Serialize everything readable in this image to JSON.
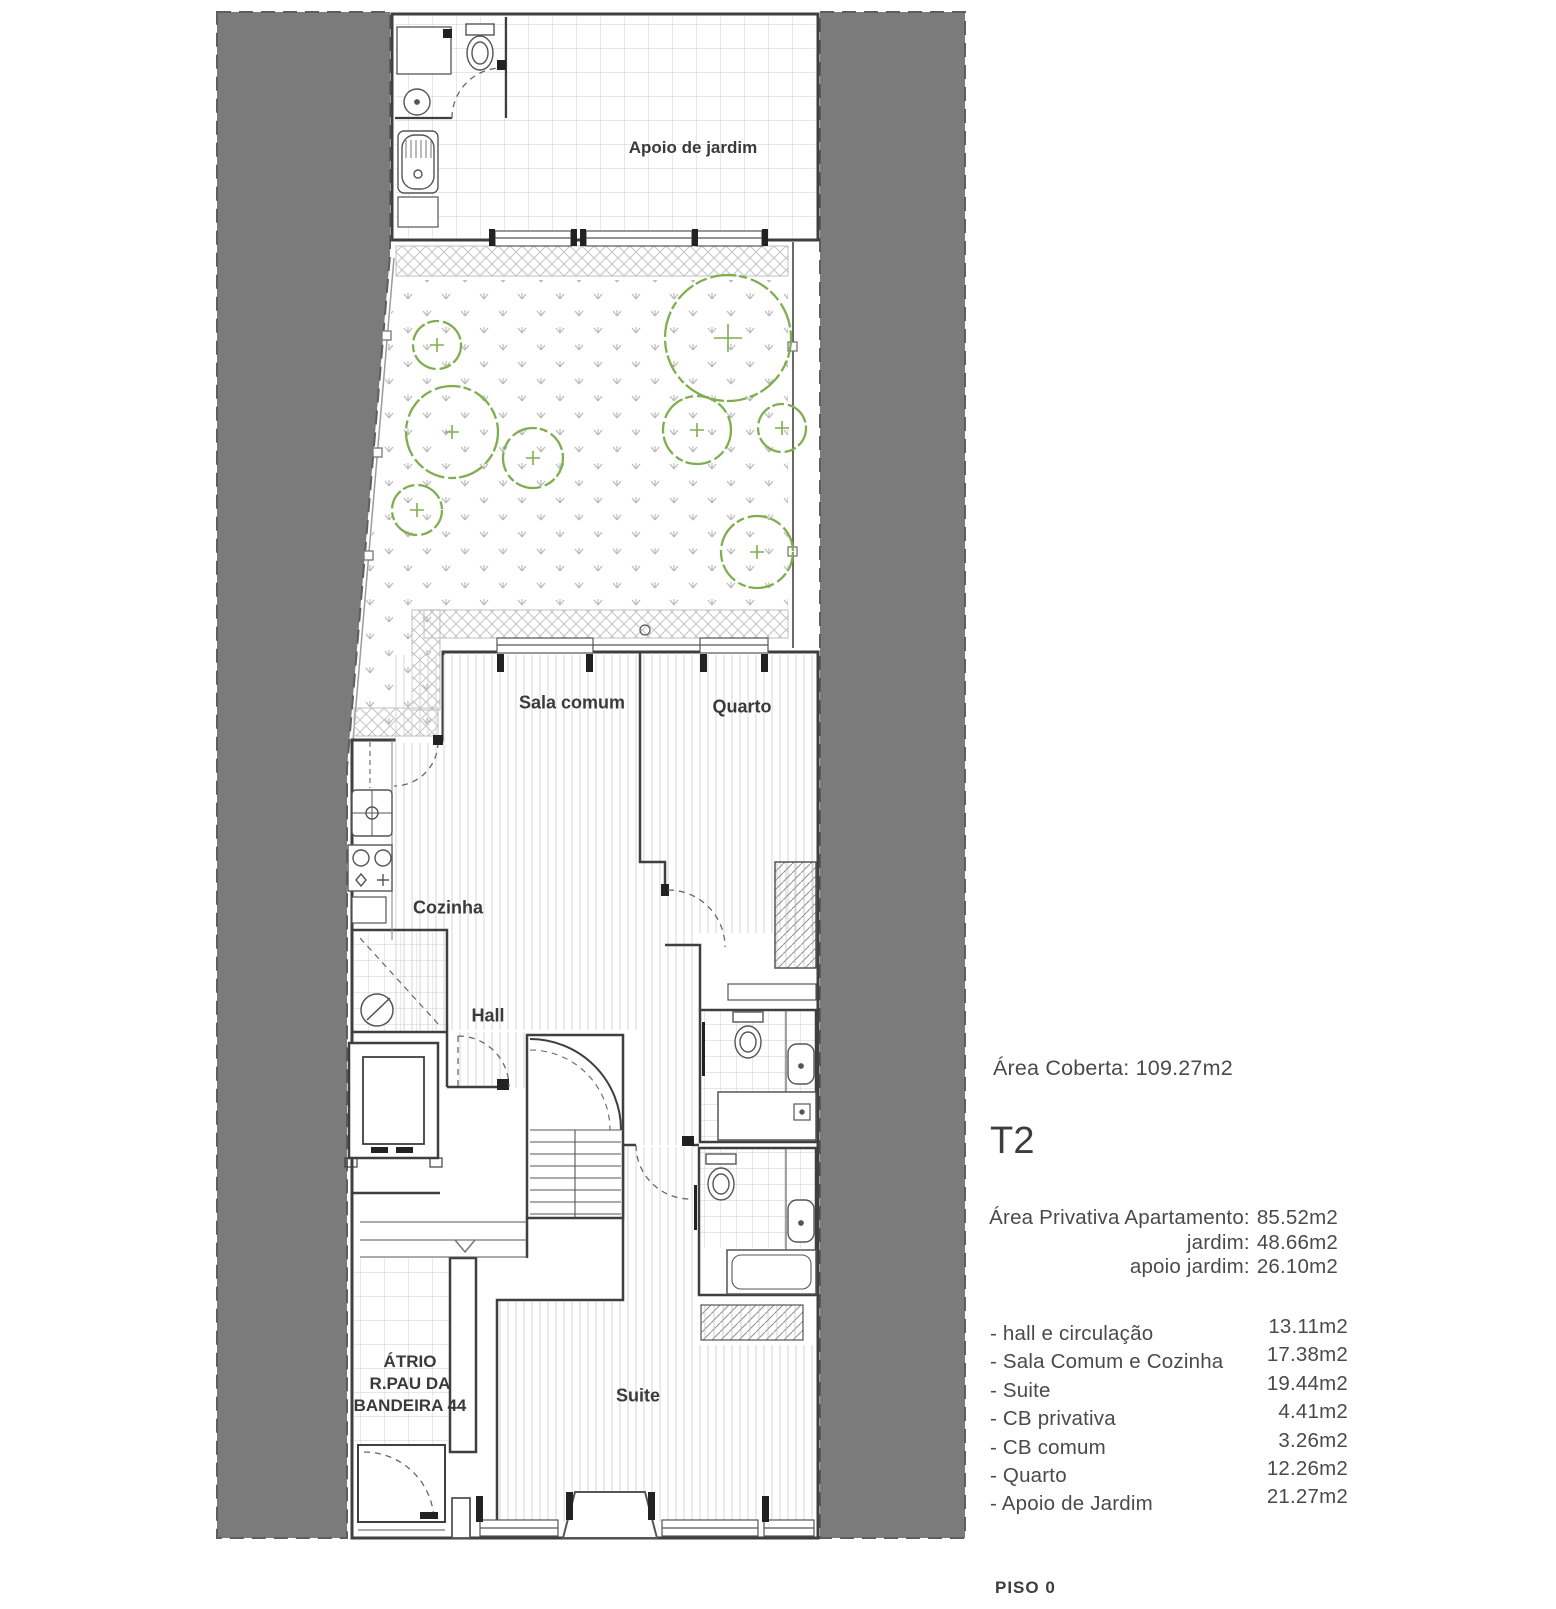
{
  "floor_plan": {
    "rooms": [
      {
        "id": "apoio-de-jardim",
        "label": "Apoio de jardim"
      },
      {
        "id": "sala-comum",
        "label": "Sala comum"
      },
      {
        "id": "quarto",
        "label": "Quarto"
      },
      {
        "id": "cozinha",
        "label": "Cozinha"
      },
      {
        "id": "hall",
        "label": "Hall"
      },
      {
        "id": "suite",
        "label": "Suite"
      }
    ],
    "atrio": {
      "line1": "ÁTRIO",
      "line2": "R.PAU DA",
      "line3": "BANDEIRA 44"
    }
  },
  "info_panel": {
    "area_coberta": "Área Coberta: 109.27m2",
    "unit_type": "T2",
    "private_areas": [
      {
        "label": "Área Privativa Apartamento:",
        "value": "85.52m2"
      },
      {
        "label": "jardim:",
        "value": "48.66m2"
      },
      {
        "label": "apoio jardim:",
        "value": "26.10m2"
      }
    ],
    "room_areas": [
      {
        "label": "- hall e circulação",
        "value": "13.11m2"
      },
      {
        "label": "- Sala Comum e Cozinha",
        "value": "17.38m2"
      },
      {
        "label": "- Suite",
        "value": "19.44m2"
      },
      {
        "label": "- CB privativa",
        "value": "4.41m2"
      },
      {
        "label": "- CB comum",
        "value": "3.26m2"
      },
      {
        "label": "- Quarto",
        "value": "12.26m2"
      },
      {
        "label": "- Apoio de Jardim",
        "value": "21.27m2"
      }
    ],
    "floor_label": "PISO 0"
  },
  "colors": {
    "neighbor_gray": "#7b7b7b",
    "wall": "#3f3f3f",
    "vegetation_green": "#7fae4f",
    "hatch_gray": "#c4c4c4"
  }
}
